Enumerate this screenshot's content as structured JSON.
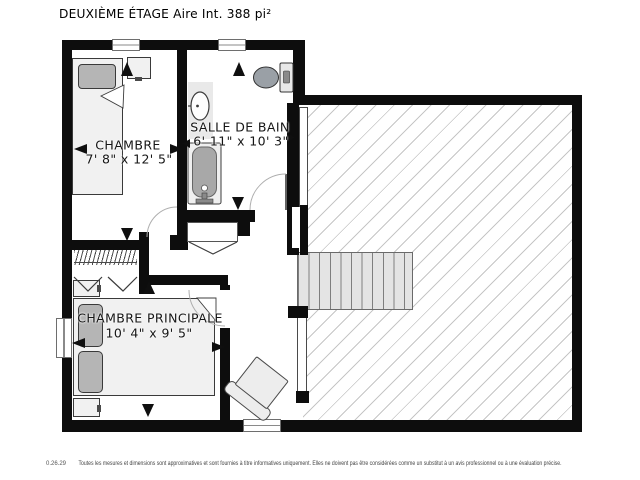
{
  "page": {
    "title": "DEUXIÈME ÉTAGE Aire Int. 388 pi²"
  },
  "rooms": [
    {
      "name": "CHAMBRE",
      "dims": "7' 8\" x 12' 5\""
    },
    {
      "name": "SALLE DE BAIN",
      "dims": "6' 11\" x 10' 3\""
    },
    {
      "name": "CHAMBRE PRINCIPALE",
      "dims": "10' 4\" x 9' 5\""
    }
  ],
  "footer": {
    "version": "0.26.29",
    "disclaimer": "Toutes les mesures et dimensions sont approximatives et sont fournies à titre informatives uniquement. Elles ne doivent pas être considérées comme un substitut à un avis professionnel ou à une évaluation précise."
  },
  "colors": {
    "wall": "#0d0d0d",
    "hatch": "#c6c6c6",
    "furniture_fill": "#f1f1f1",
    "furniture_dark": "#b5b5b5"
  },
  "symbols": [
    "bed-icon",
    "double-bed-icon",
    "nightstand-icon",
    "toilet-icon",
    "sink-icon",
    "bathtub-icon",
    "armchair-icon",
    "stairs-icon",
    "window-icon",
    "door-arc-icon",
    "bifold-door-icon",
    "closet-hangers-icon",
    "dimension-arrow-icon"
  ]
}
